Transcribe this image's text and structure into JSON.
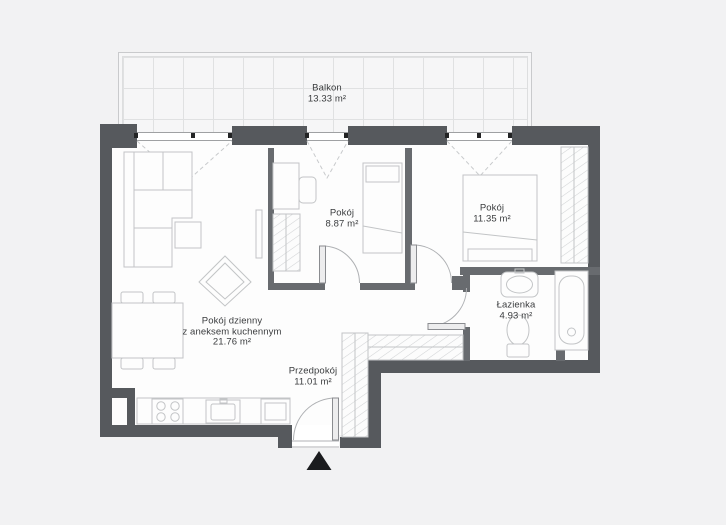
{
  "plan": {
    "title": "Apartment floor plan",
    "rooms": {
      "balcony": {
        "name": "Balkon",
        "area": "13.33 m²"
      },
      "living_room": {
        "name": "Pokój dzienny",
        "name2": "z aneksem kuchennym",
        "area": "21.76 m²"
      },
      "room_small": {
        "name": "Pokój",
        "area": "8.87 m²"
      },
      "room_large": {
        "name": "Pokój",
        "area": "11.35 m²"
      },
      "bathroom": {
        "name": "Łazienka",
        "area": "4.93 m²"
      },
      "hallway": {
        "name": "Przedpokój",
        "area": "11.01 m²"
      }
    },
    "icons": {
      "entrance": "entrance-arrow-up"
    },
    "colors": {
      "background": "#f2f2f3",
      "floor": "#fdfdfd",
      "wall": "#56595d",
      "wall_interior": "#686b6f",
      "furniture_line": "#c2c4c6",
      "text": "#3a3c3e",
      "black": "#1b1c1e"
    }
  }
}
